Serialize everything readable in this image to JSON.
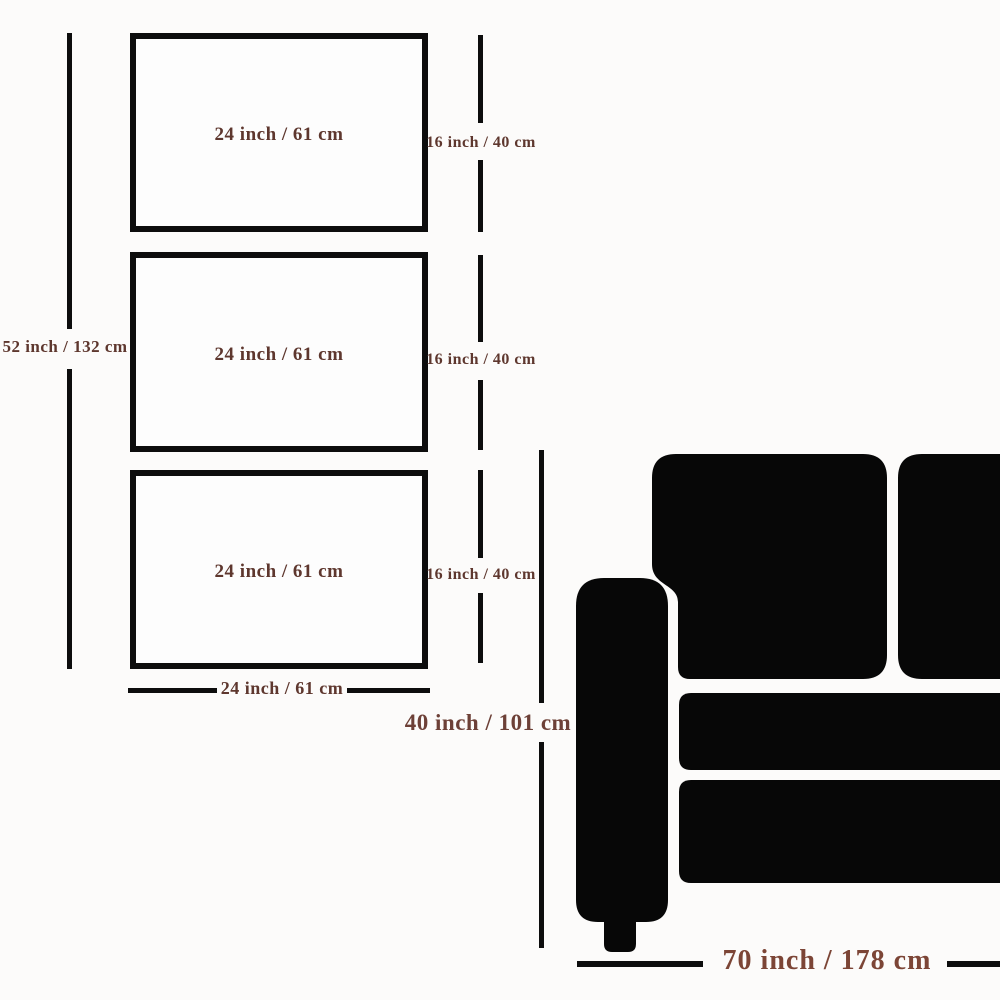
{
  "canvas_set": {
    "panels": [
      {
        "width_label": "24 inch / 61 cm",
        "height_label": "16 inch / 40 cm"
      },
      {
        "width_label": "24 inch / 61 cm",
        "height_label": "16 inch / 40 cm"
      },
      {
        "width_label": "24 inch / 61 cm",
        "height_label": "16 inch / 40 cm"
      }
    ],
    "total_height_label": "52 inch / 132 cm",
    "bottom_width_label": "24 inch / 61 cm"
  },
  "sofa": {
    "height_label": "40 inch / 101 cm",
    "width_label": "70 inch / 178 cm"
  },
  "colors": {
    "background": "#fcfbfa",
    "line_black": "#0d0d0d",
    "sofa_black": "#070707",
    "label_brown": "#5e372e",
    "label_brown_medium": "#6d4037",
    "label_brown_large": "#7c4536",
    "panel_fill": "#fdfdfd"
  }
}
